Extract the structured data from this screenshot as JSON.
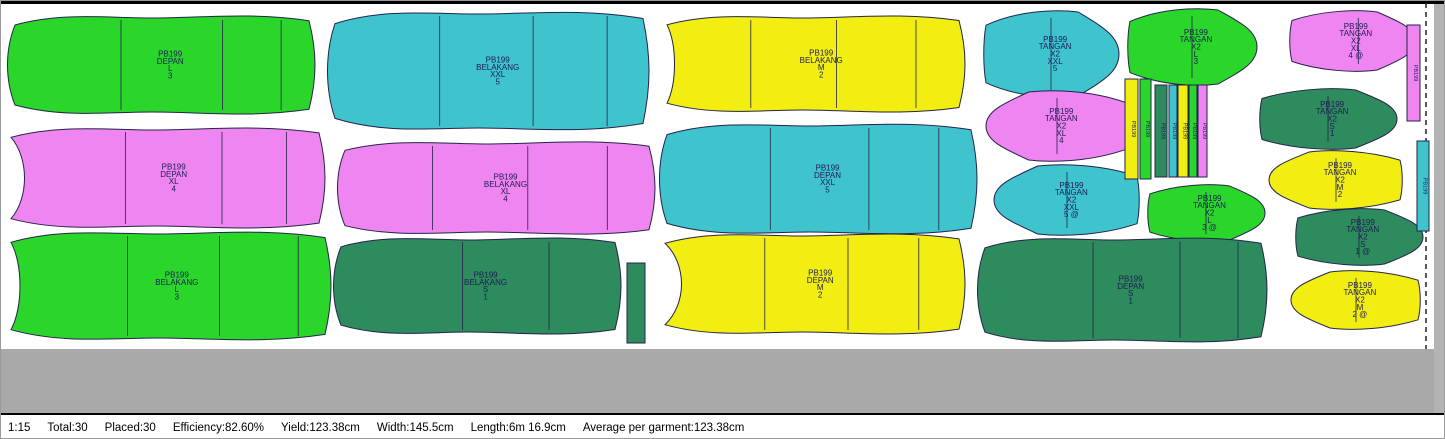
{
  "app": {
    "title": "Marker layout - PB199",
    "marker_name": "PB199"
  },
  "colors": {
    "S": "#2e8b5e",
    "M": "#f2ee12",
    "L": "#2bd62b",
    "XL": "#ef85f0",
    "XXL": "#3fc3cd",
    "outline": "#23234a",
    "label_text": "#1c1c55",
    "outside_marker": "#a9a9a9",
    "marker_background": "#ffffff"
  },
  "status_bar": {
    "scale": "1:15",
    "total": "Total:30",
    "placed": "Placed:30",
    "efficiency": "Efficiency:82.60%",
    "yield": "Yield:123.38cm",
    "width": "Width:145.5cm",
    "length": "Length:6m 16.9cm",
    "average": "Average per garment:123.38cm"
  },
  "pieces": [
    {
      "id": "depan-l-3",
      "size": "L",
      "lines": [
        "PB199",
        "DEPAN",
        "L",
        "3"
      ]
    },
    {
      "id": "belakang-xxl-5",
      "size": "XXL",
      "lines": [
        "PB199",
        "BELAKANG",
        "XXL",
        "5"
      ]
    },
    {
      "id": "belakang-m-2",
      "size": "M",
      "lines": [
        "PB199",
        "BELAKANG",
        "M",
        "2"
      ]
    },
    {
      "id": "tangan-xxl-5",
      "size": "XXL",
      "lines": [
        "PB199",
        "TANGAN",
        "X2",
        "XXL",
        "5"
      ]
    },
    {
      "id": "tangan-l-3",
      "size": "L",
      "lines": [
        "PB199",
        "TANGAN",
        "X2",
        "L",
        "3"
      ]
    },
    {
      "id": "tangan-xl-4a",
      "size": "XL",
      "lines": [
        "PB199",
        "TANGAN",
        "X2",
        "XL",
        "4 @"
      ]
    },
    {
      "id": "strip-xl",
      "size": "XL",
      "lines": [
        "PB199"
      ]
    },
    {
      "id": "depan-xl-4",
      "size": "XL",
      "lines": [
        "PB199",
        "DEPAN",
        "XL",
        "4"
      ]
    },
    {
      "id": "belakang-xl-4",
      "size": "XL",
      "lines": [
        "PB199",
        "BELAKANG",
        "XL",
        "4"
      ]
    },
    {
      "id": "depan-xxl-5",
      "size": "XXL",
      "lines": [
        "PB199",
        "DEPAN",
        "XXL",
        "5"
      ]
    },
    {
      "id": "tangan-xl-4",
      "size": "XL",
      "lines": [
        "PB199",
        "TANGAN",
        "X2",
        "XL",
        "4"
      ]
    },
    {
      "id": "tangan-xxl-5a",
      "size": "XXL",
      "lines": [
        "PB199",
        "TANGAN",
        "X2",
        "XXL",
        "5 @"
      ]
    },
    {
      "id": "strip-m-1",
      "size": "M",
      "lines": [
        "PB199"
      ]
    },
    {
      "id": "strip-l-1",
      "size": "L",
      "lines": [
        "PB199"
      ]
    },
    {
      "id": "strip-s-1",
      "size": "S",
      "lines": [
        "PB199"
      ]
    },
    {
      "id": "strip-xxl-1",
      "size": "XXL",
      "lines": [
        "PB199"
      ]
    },
    {
      "id": "strip-m-2",
      "size": "M",
      "lines": [
        "PB199"
      ]
    },
    {
      "id": "strip-l-2",
      "size": "L",
      "lines": [
        "PB199"
      ]
    },
    {
      "id": "strip-xl-2",
      "size": "XL",
      "lines": [
        "PB199"
      ]
    },
    {
      "id": "tangan-l-3a",
      "size": "L",
      "lines": [
        "PB199",
        "TANGAN",
        "X2",
        "L",
        "3 @"
      ]
    },
    {
      "id": "tangan-s-1",
      "size": "S",
      "lines": [
        "PB199",
        "TANGAN",
        "X2",
        "S",
        "1"
      ]
    },
    {
      "id": "tangan-m-2",
      "size": "M",
      "lines": [
        "PB199",
        "TANGAN",
        "X2",
        "M",
        "2"
      ]
    },
    {
      "id": "tangan-s-1a",
      "size": "S",
      "lines": [
        "PB199",
        "TANGAN",
        "X2",
        "S",
        "1 @"
      ]
    },
    {
      "id": "strip-xxl-2",
      "size": "XXL",
      "lines": [
        "PB199"
      ]
    },
    {
      "id": "belakang-l-3",
      "size": "L",
      "lines": [
        "PB199",
        "BELAKANG",
        "L",
        "3"
      ]
    },
    {
      "id": "belakang-s-1",
      "size": "S",
      "lines": [
        "PB199",
        "BELAKANG",
        "S",
        "1"
      ]
    },
    {
      "id": "strip-s-2",
      "size": "S",
      "lines": []
    },
    {
      "id": "depan-m-2",
      "size": "M",
      "lines": [
        "PB199",
        "DEPAN",
        "M",
        "2"
      ]
    },
    {
      "id": "depan-s-1",
      "size": "S",
      "lines": [
        "PB199",
        "DEPAN",
        "S",
        "1"
      ]
    },
    {
      "id": "tangan-m-2a",
      "size": "M",
      "lines": [
        "PB199",
        "TANGAN",
        "X2",
        "M",
        "2 @"
      ]
    }
  ]
}
